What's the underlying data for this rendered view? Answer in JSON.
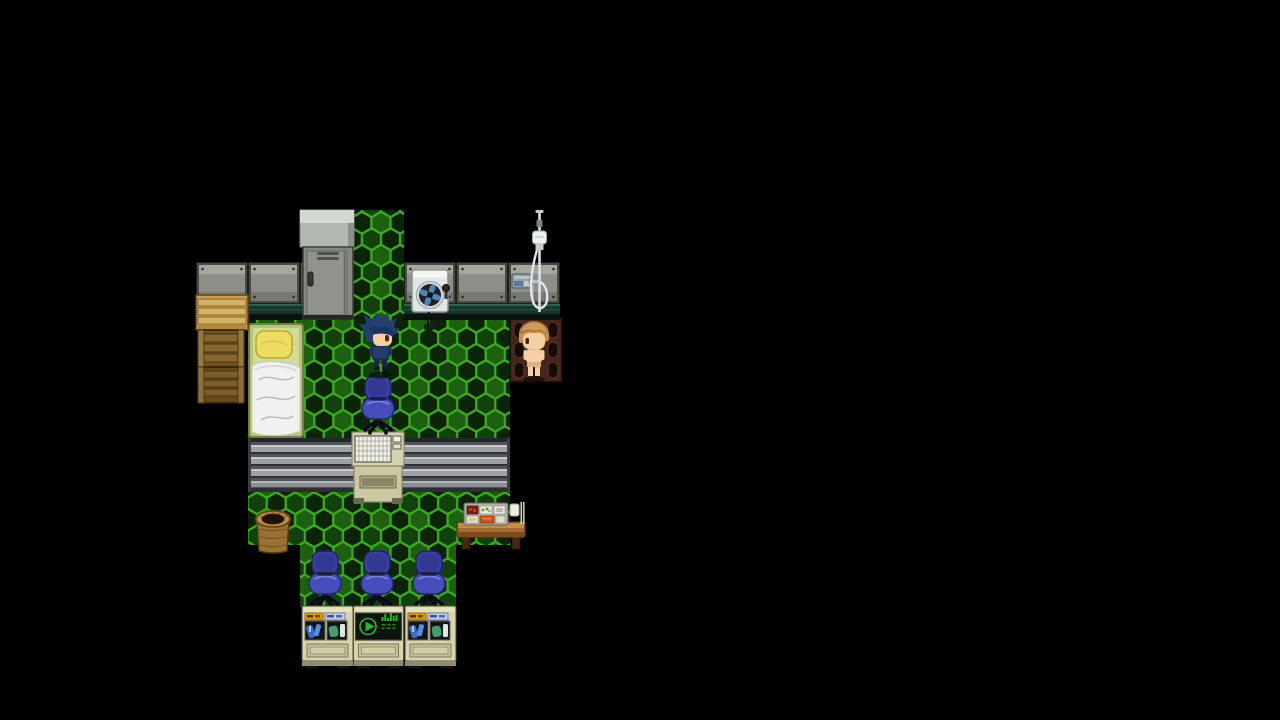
{
  "meta": {
    "domain": "Game",
    "description": "Top-down 2D RPG interior room (pixel-art style) rendered in a letterboxed game viewport on a black screen",
    "viewport": "1280x720",
    "visible_text": []
  },
  "palette": {
    "bg": "#000000",
    "hex_base": "#0a1c06",
    "hex_line": "#3dab20",
    "hex_dark": "#0b2306",
    "hex_mid": "#1d6110",
    "hex_middark": "#12420b",
    "wall_panel": "#8d9088",
    "wall_teal": "#17352c",
    "metal": "#515459",
    "metal_light": "#9da1a6",
    "beige": "#d8d4ae",
    "chair_back": "#3a3fa6",
    "chair_seat": "#474dbb",
    "wood": "#a36a32",
    "crate_wood": "#c7a050",
    "skin": "#f6cfa4",
    "player_hair": "#23406e",
    "npc_hair": "#c78f4e",
    "screen_green": "#2fb32f",
    "grate_brown": "#43251b",
    "bed_frame": "#b9c378",
    "pillow": "#ecdc60",
    "blanket": "#f1f2ef"
  },
  "scene": {
    "room": "dormitory / lab room with green hexagon-tile floor and concrete panel walls",
    "entities": [
      {
        "id": "hex-floor",
        "label": "green hexagonal tiled floor"
      },
      {
        "id": "concrete-wall",
        "label": "gray concrete panel wall with teal baseboard"
      },
      {
        "id": "metal-locker",
        "label": "gray metal locker with vents and handle"
      },
      {
        "id": "wooden-crates",
        "label": "stacked wooden crates (left wall)"
      },
      {
        "id": "bed",
        "label": "bed with yellow pillow and white crumpled blanket"
      },
      {
        "id": "washing-machine",
        "label": "white wall unit with round fan/drum"
      },
      {
        "id": "shower",
        "label": "shower stand with hanging hose and wall valve"
      },
      {
        "id": "drain-grate",
        "label": "brown floor drain grate"
      },
      {
        "id": "player-character",
        "label": "player sprite, spiky dark-blue hair, navy outfit, facing right"
      },
      {
        "id": "npc-character",
        "label": "shirtless NPC sprite, sandy-brown hair, facing left, standing on grate"
      },
      {
        "id": "office-chair",
        "label": "blue swivel office chair",
        "count": 4
      },
      {
        "id": "conveyor-counter",
        "label": "gray ribbed metal counter/conveyor strip"
      },
      {
        "id": "control-console",
        "label": "beige console desk with keyboard"
      },
      {
        "id": "basket",
        "label": "round woven basket"
      },
      {
        "id": "food-desk",
        "label": "wooden desk with compartment meal tray and cup"
      },
      {
        "id": "vending-machine",
        "label": "beige vending machine with two display windows",
        "count": 2
      },
      {
        "id": "monitor-console",
        "label": "beige cabinet with dark screen showing green play symbol and equalizer"
      }
    ]
  }
}
